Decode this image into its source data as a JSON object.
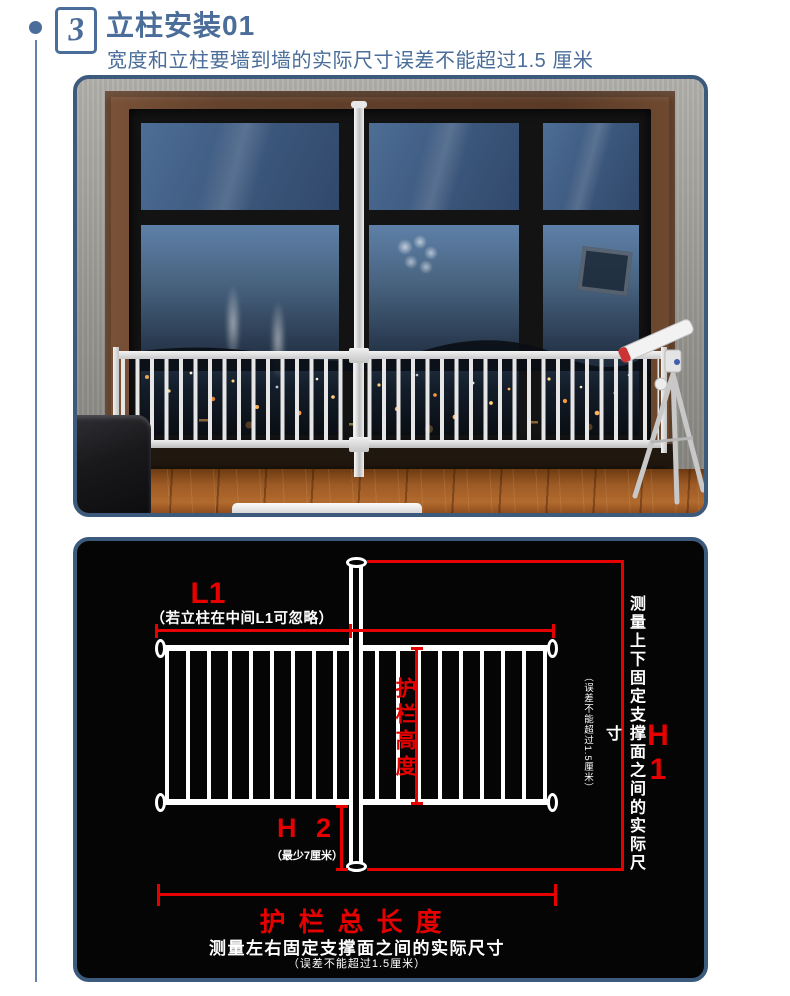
{
  "colors": {
    "accent_blue": "#4a6d99",
    "panel_border": "#3c5a7c",
    "dimension_red": "#e60000",
    "diagram_background": "#050505",
    "diagram_text": "#ffffff"
  },
  "header": {
    "step_number": "3",
    "title": "立柱安装01",
    "subtitle": "宽度和立柱要墙到墙的实际尺寸误差不能超过1.5 厘米"
  },
  "diagram": {
    "l1_label": "L1",
    "l1_note": "（若立柱在中间L1可忽略）",
    "height_label": "护栏高度",
    "h2_label": "H 2",
    "h2_note": "（最少7厘米）",
    "h1_label": "H 1",
    "vertical_note": "测量上下固定支撑面之间的实际尺寸",
    "vertical_note_sub": "（误差不能超过1.5厘米）",
    "total_length_label": "护栏总长度",
    "total_length_note": "测量左右固定支撑面之间的实际尺寸",
    "total_length_note_sub": "（误差不能超过1.5厘米）"
  }
}
